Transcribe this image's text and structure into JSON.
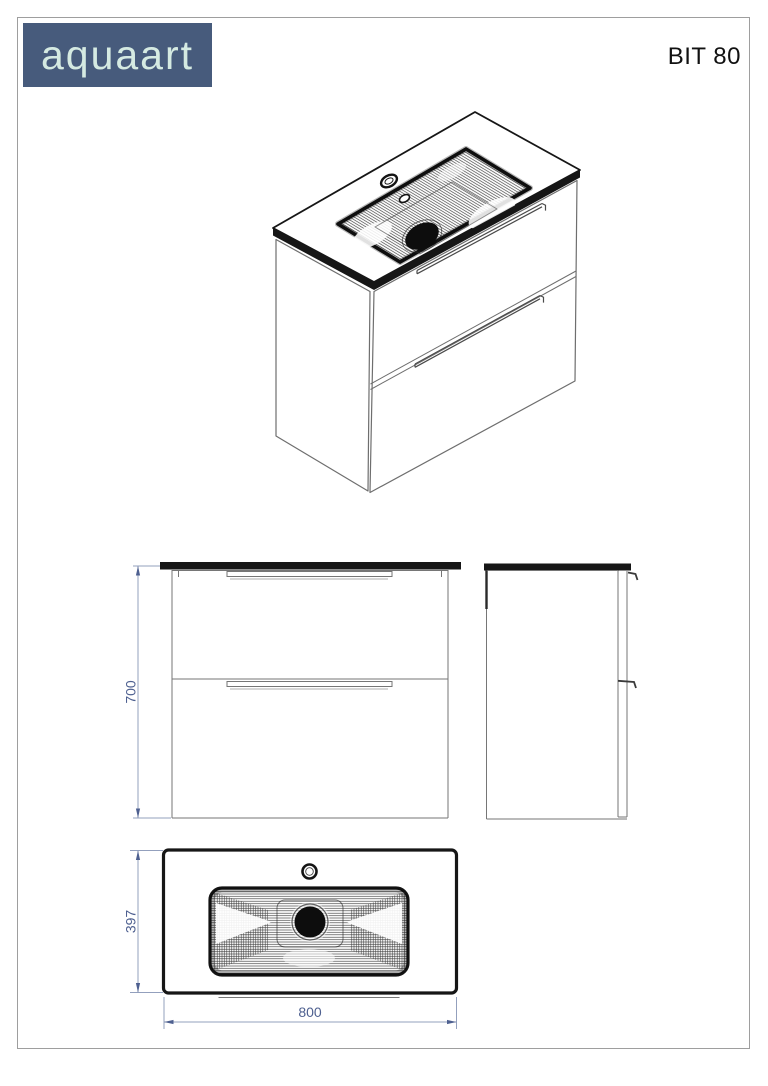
{
  "brand": {
    "name": "aquaart"
  },
  "sheet": {
    "model_label": "BIT 80"
  },
  "dimensions": {
    "height": "700",
    "depth": "397",
    "width": "800"
  },
  "colors": {
    "logo_bg": "#475b7c",
    "logo_fg": "#d5eae2",
    "dim_text": "#4e6090",
    "dim_line": "#93a0bd",
    "outline": "#161616",
    "line_grey": "#767676",
    "sheet_border": "#9e9e9e"
  }
}
